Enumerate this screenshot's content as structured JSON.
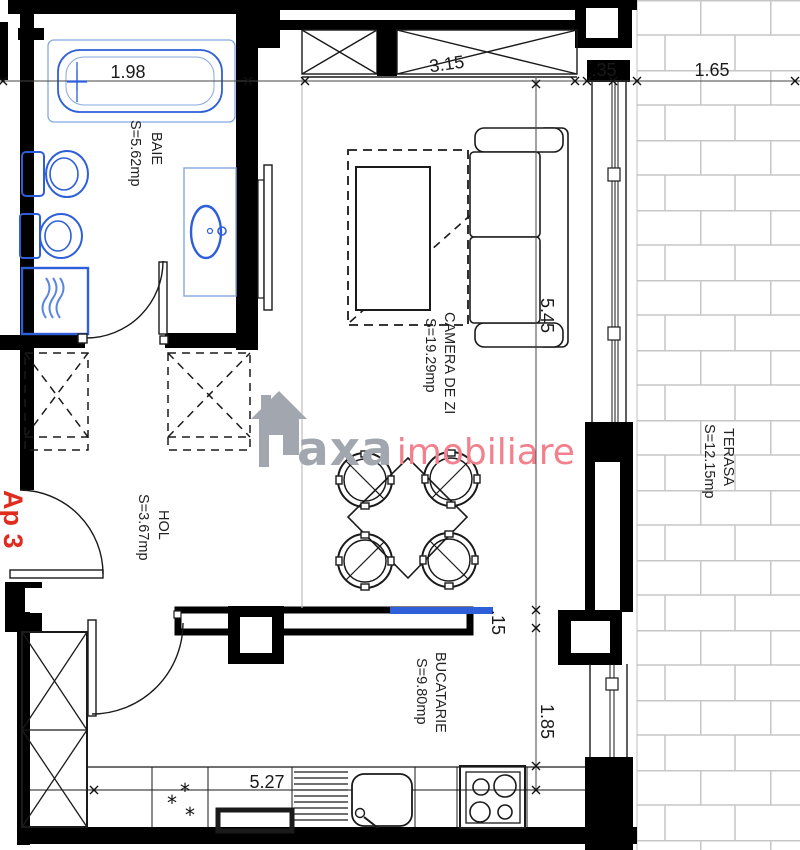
{
  "plan": {
    "apartment_label": "Ap 3",
    "rooms": {
      "baie": {
        "name": "BAIE",
        "area": "S=5.62mp"
      },
      "hol": {
        "name": "HOL",
        "area": "S=3.67mp"
      },
      "camera_de_zi": {
        "name": "CAMERA DE ZI",
        "area": "S=19.29mp"
      },
      "bucatarie": {
        "name": "BUCATARIE",
        "area": "S=9.80mp"
      },
      "terasa": {
        "name": "TERASA",
        "area": "S=12.15mp"
      }
    },
    "dimensions": {
      "bathtub_width": "1.98",
      "living_window_width": "3.15",
      "wall_thickness": ".35",
      "terrace_width": "1.65",
      "living_depth": "5.45",
      "kitchen_gap": ".15",
      "kitchen_depth": "1.85",
      "kitchen_width": "5.27"
    },
    "symbols": {
      "star": "*"
    },
    "watermark": {
      "brand": "axa",
      "suffix": "imobiliare"
    },
    "colors": {
      "wall": "#000000",
      "fixture_blue": "#2f5fd8",
      "fixture_light_blue": "#85a8e2",
      "brick_gray": "#c6c6c6",
      "apartment_red": "#e02b20",
      "watermark_gray": "#a2a7af",
      "watermark_pink": "#f2818d"
    }
  }
}
